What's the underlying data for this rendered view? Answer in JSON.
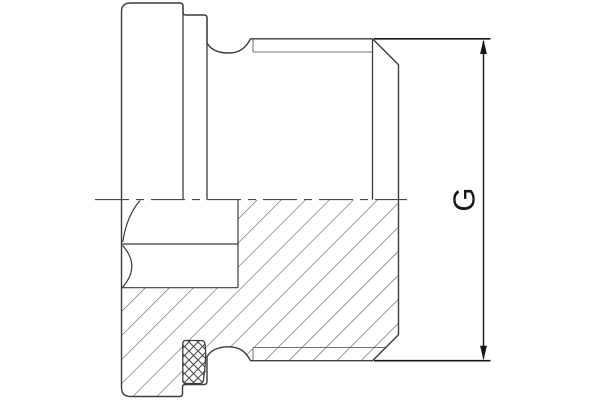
{
  "drawing": {
    "dimension_label": "G"
  },
  "colors": {
    "background": "#ffffff",
    "outline_line": "#3c3c3c",
    "thin_thread_line": "#707070",
    "dimension_line": "#161616",
    "hatch_line": "#4d4d4d",
    "centerline": "#4a4a4a"
  }
}
